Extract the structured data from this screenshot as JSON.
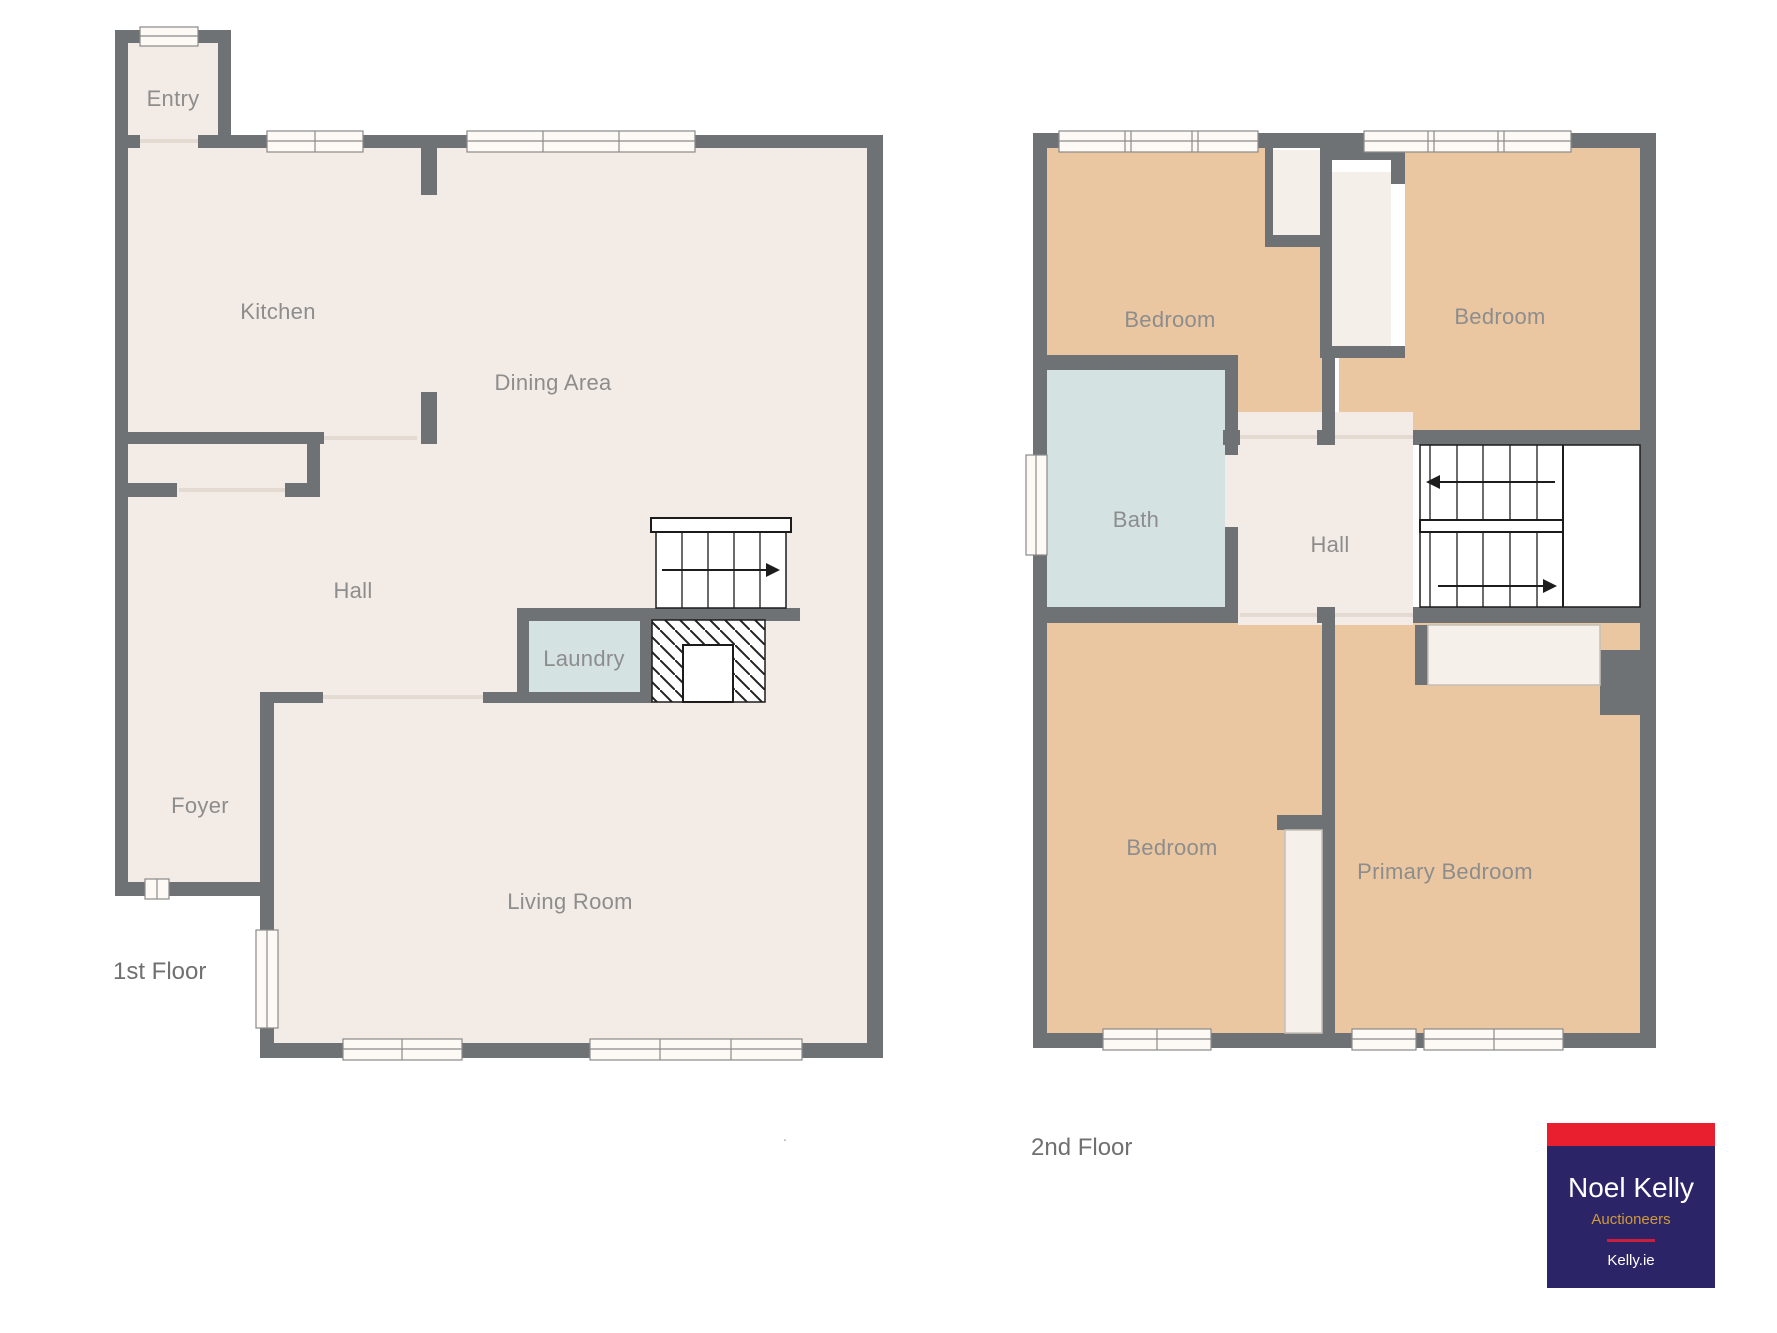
{
  "floors": [
    {
      "title": "1st Floor",
      "rooms": [
        {
          "label": "Entry"
        },
        {
          "label": "Kitchen"
        },
        {
          "label": "Dining Area"
        },
        {
          "label": "Hall"
        },
        {
          "label": "Laundry"
        },
        {
          "label": "Foyer"
        },
        {
          "label": "Living Room"
        }
      ]
    },
    {
      "title": "2nd Floor",
      "rooms": [
        {
          "label": "Bedroom"
        },
        {
          "label": "Bedroom"
        },
        {
          "label": "Bath"
        },
        {
          "label": "Hall"
        },
        {
          "label": "Bedroom"
        },
        {
          "label": "Primary Bedroom"
        }
      ]
    }
  ],
  "logo": {
    "brand": "Noel Kelly",
    "tagline": "Auctioneers",
    "website": "Kelly.ie"
  },
  "footnote_dot": ".",
  "colors": {
    "wall": "#6e7275",
    "floor_cream": "#f3ebe5",
    "closet_cream": "#f5efe9",
    "bedroom_peach": "#ebc7a1",
    "wet_room_blue": "#d5e2e2",
    "label_gray": "#8d8d8d",
    "logo_red": "#e91e2f",
    "logo_navy": "#2b2467",
    "logo_gold": "#d09a3a",
    "logo_rule_red": "#cc1f3e"
  }
}
